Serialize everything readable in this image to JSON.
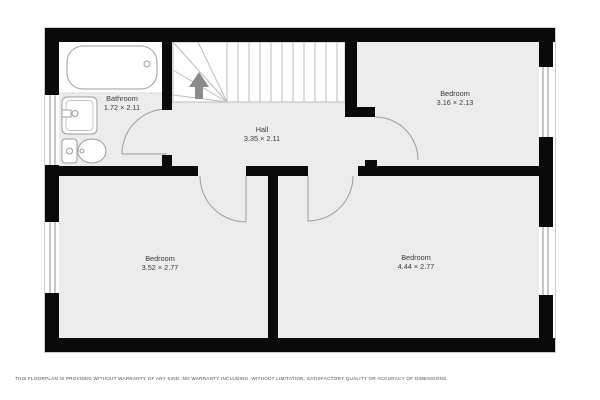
{
  "floorplan": {
    "rooms": [
      {
        "name": "Bathroom",
        "dims": "1.72 × 2.11"
      },
      {
        "name": "Hall",
        "dims": "3.35 × 2.11"
      },
      {
        "name": "Bedroom",
        "dims": "3.16 × 2.13"
      },
      {
        "name": "Bedroom",
        "dims": "3.52 × 2.77"
      },
      {
        "name": "Bedroom",
        "dims": "4.44 × 2.77"
      }
    ],
    "stairs": {
      "direction_icon": "up-arrow",
      "tread_count": 11
    },
    "fixture_icons": [
      "bathtub-icon",
      "sink-icon",
      "toilet-icon"
    ],
    "window_count": 4,
    "disclaimer": "THIS FLOORPLAN IS PROVIDED WITHOUT WARRANTY OF ANY KIND. NO WARRANTY INCLUDING, WITHOUT LIMITATION, SATISFACTORY QUALITY OR ACCURACY OF DIMENSIONS.",
    "colors": {
      "wall": "#0a0a0a",
      "floor": "#ececec",
      "stair_area": "#ffffff",
      "stair_lines": "#bcbcbc",
      "stair_arrow": "#8c8c8c",
      "door_arc": "#9c9c9c",
      "fixture_stroke": "#9c9c9c",
      "window_line": "#8f8f8f",
      "label_text": "#3b3b3b",
      "disclaimer_text": "#4a4a4a"
    }
  }
}
